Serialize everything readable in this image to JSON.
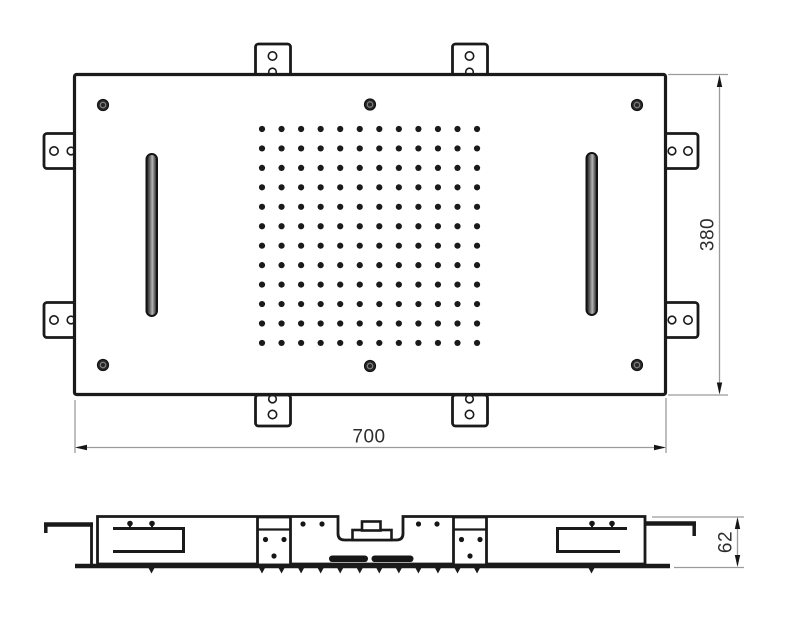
{
  "drawing": {
    "type": "technical-drawing",
    "subject": "ceiling-mounted shower head panel, top view and side profile",
    "dimensions": {
      "width_label": "700",
      "height_label": "380",
      "depth_label": "62"
    },
    "colors": {
      "outline": "#1a1a1a",
      "dim_line": "#9b9b9b",
      "dim_text": "#2d2d2d",
      "fill": "#ffffff",
      "slot_dark": "#121212",
      "slot_light": "#b5b5b5"
    },
    "nozzle_grid": {
      "cols": 12,
      "rows": 12,
      "x_start": 262,
      "y_start": 129,
      "x_step": 19.55,
      "y_step": 19.45,
      "dot_radius": 3.1
    },
    "side_nozzle_teeth": {
      "count": 12,
      "x_start": 262,
      "x_step": 19.55,
      "y_top": 567,
      "depth": 6.5,
      "half_width": 3.5,
      "extra_x": [
        151.5,
        591.5
      ]
    }
  }
}
